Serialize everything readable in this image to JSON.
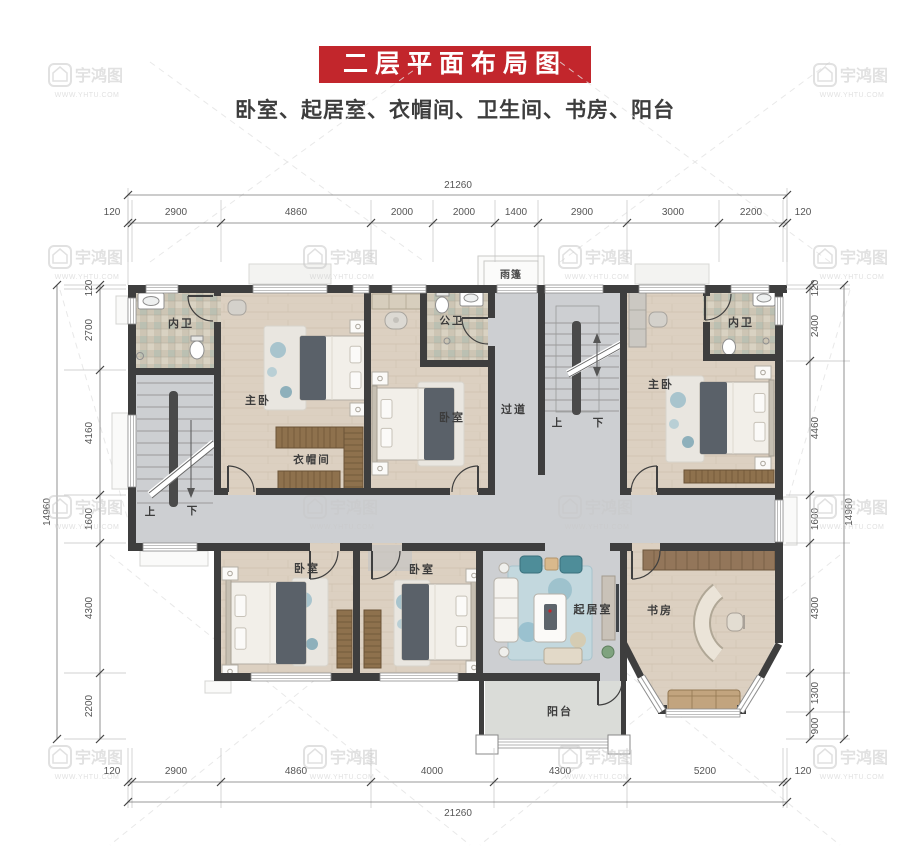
{
  "header": {
    "title": "二层平面布局图",
    "subtitle": "卧室、起居室、衣帽间、卫生间、书房、阳台"
  },
  "colors": {
    "accent_red": "#c2262c",
    "wall": "#3e3e3e",
    "wood_floor": "#dcd0c1",
    "marble_floor": "#cdcfd2",
    "tile_floor": "#cdc5b4",
    "dim_text": "#555555",
    "watermark": "#c9c9c9"
  },
  "watermark": {
    "brand": "宇鸿图",
    "url": "WWW.YHTU.COM"
  },
  "rooms": {
    "bath_tl": "内卫",
    "master_tl": "主卧",
    "cloak": "衣帽间",
    "bed_mid": "卧室",
    "bath_pub": "公卫",
    "corridor": "过道",
    "up_left": "上",
    "down_left": "下",
    "up_center": "上",
    "down_center": "下",
    "master_tr": "主卧",
    "bath_tr": "内卫",
    "bed_b1": "卧室",
    "bed_b2": "卧室",
    "living": "起居室",
    "study": "书房",
    "balcony": "阳台",
    "canopy": "雨篷"
  },
  "dims": {
    "top": {
      "total": "21260",
      "segments": [
        "120",
        "2900",
        "4860",
        "2000",
        "2000",
        "1400",
        "2900",
        "3000",
        "2200",
        "120"
      ]
    },
    "bottom": {
      "total": "21260",
      "segments": [
        "120",
        "2900",
        "4860",
        "4000",
        "4300",
        "5200",
        "120"
      ]
    },
    "left": {
      "total": "14960",
      "segments": [
        "120",
        "2700",
        "4160",
        "1600",
        "4300",
        "2200"
      ]
    },
    "right": {
      "total": "14960",
      "segments": [
        "120",
        "2400",
        "4460",
        "1600",
        "4300",
        "1300",
        "900"
      ]
    }
  }
}
